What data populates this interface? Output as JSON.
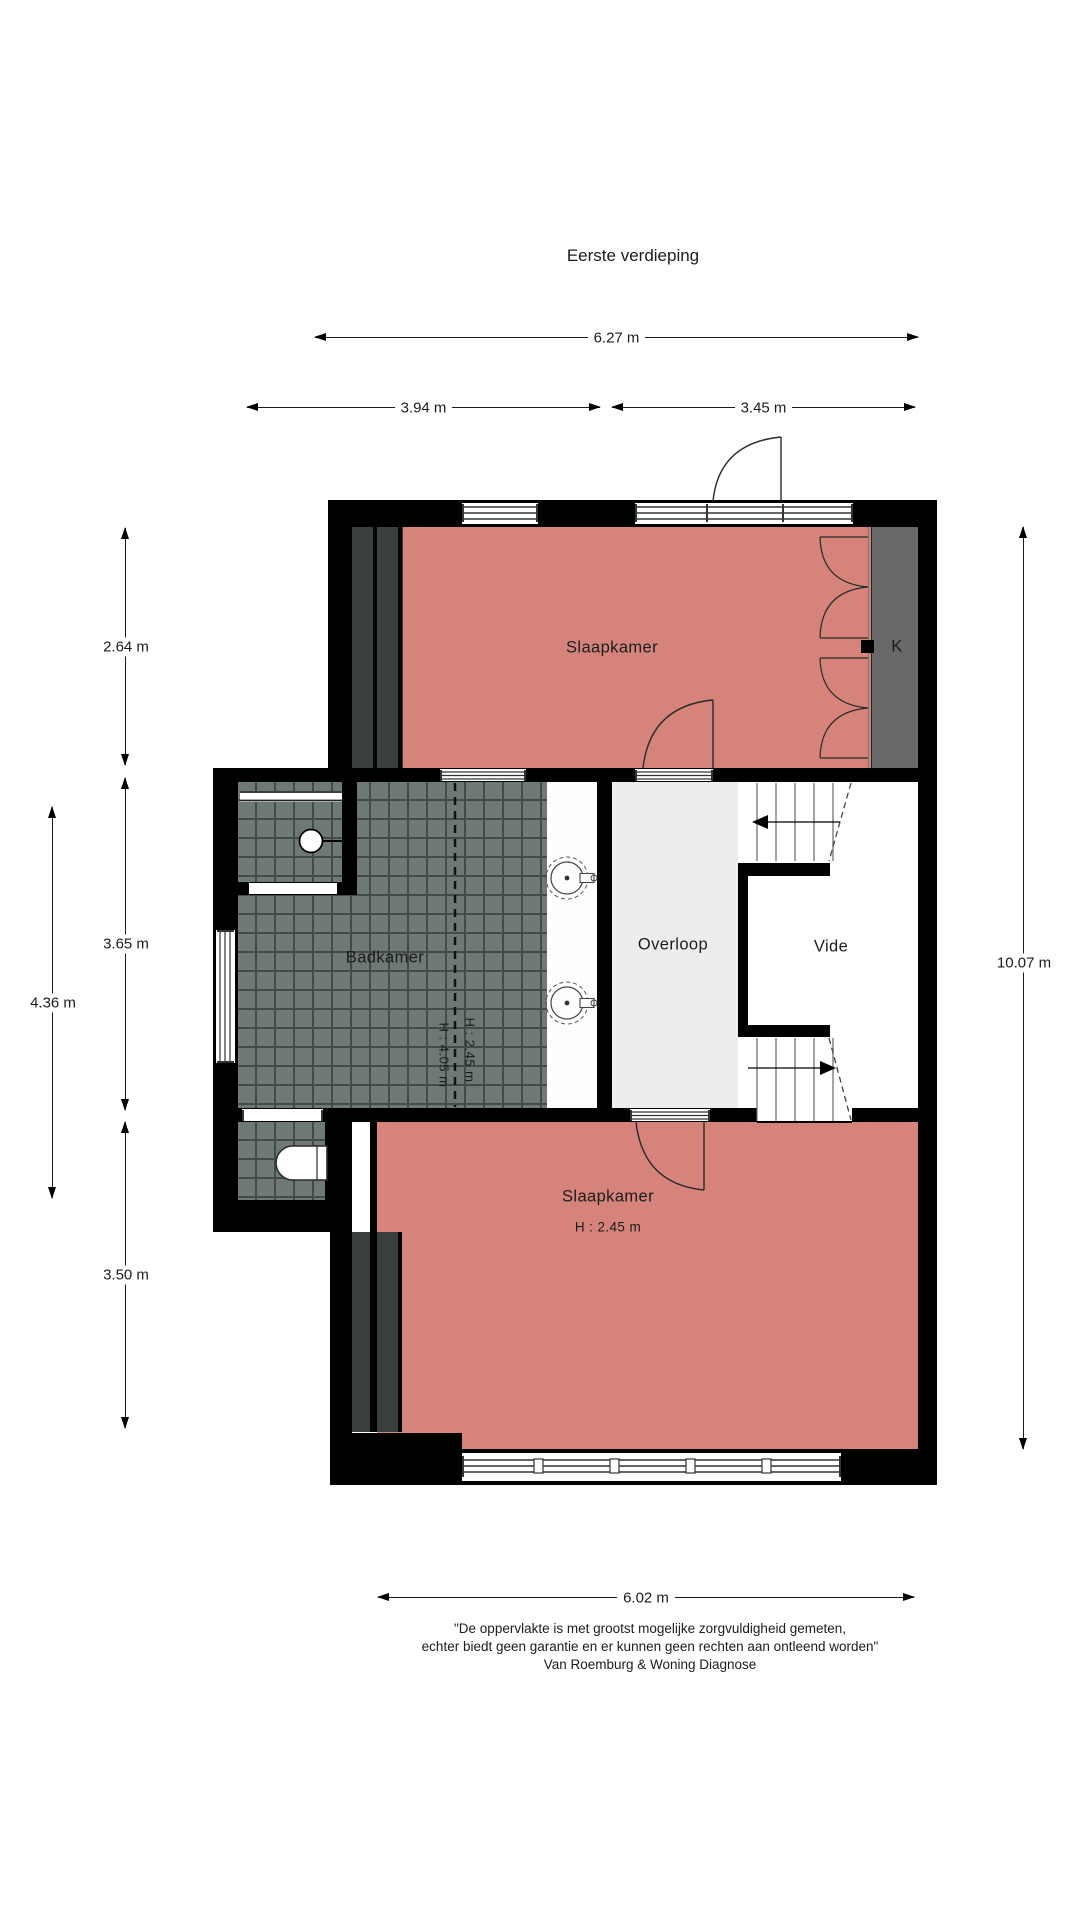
{
  "page": {
    "title": "Eerste verdieping"
  },
  "rooms": {
    "bedroom_top": {
      "label": "Slaapkamer"
    },
    "closet": {
      "label": "K"
    },
    "bathroom": {
      "label": "Badkamer",
      "height_note_low": "H : 2.45 m",
      "height_note_high": "H : 4.05 m"
    },
    "landing": {
      "label": "Overloop"
    },
    "void": {
      "label": "Vide"
    },
    "bedroom_bottom": {
      "label": "Slaapkamer",
      "height_note": "H : 2.45 m"
    }
  },
  "dimensions": {
    "top_total": "6.27 m",
    "top_left": "3.94 m",
    "top_right": "3.45 m",
    "side_top": "2.64 m",
    "side_mid": "3.65 m",
    "side_outer": "4.36 m",
    "side_bottom": "3.50 m",
    "right_total": "10.07 m",
    "bottom_total": "6.02 m"
  },
  "footer": {
    "line1": "\"De oppervlakte is met grootst mogelijke zorgvuldigheid gemeten,",
    "line2": "echter biedt geen garantie en er kunnen geen rechten aan ontleend worden\"",
    "line3": "Van Roemburg & Woning Diagnose"
  },
  "colors": {
    "room_fill": "#d5837b",
    "tile_fill": "#6e7877",
    "grout": "#424b48",
    "closet_fill": "#696969",
    "landing_fill": "#ededed",
    "wall": "#000000"
  }
}
